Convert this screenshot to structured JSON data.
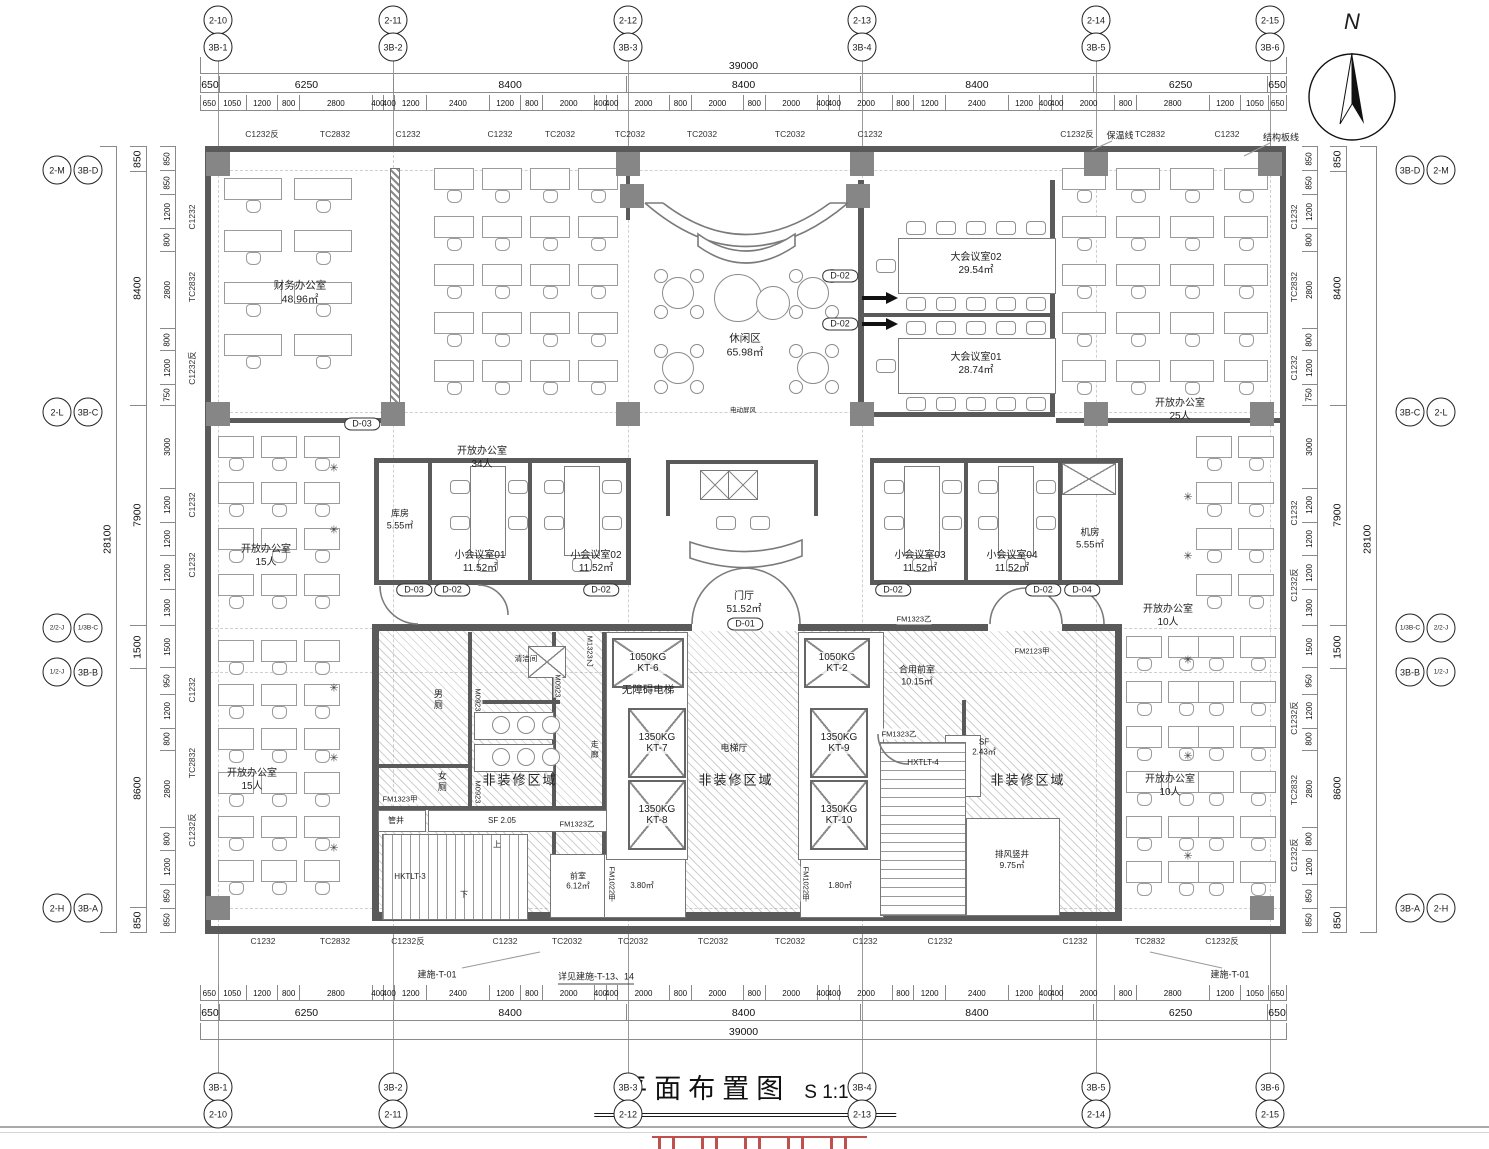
{
  "title": {
    "text": "平面布置图",
    "scale": "S 1:100"
  },
  "north": "N",
  "axes": {
    "top": [
      [
        "2-10",
        "3B-1"
      ],
      [
        "2-11",
        "3B-2"
      ],
      [
        "2-12",
        "3B-3"
      ],
      [
        "2-13",
        "3B-4"
      ],
      [
        "2-14",
        "3B-5"
      ],
      [
        "2-15",
        "3B-6"
      ]
    ],
    "bottom": [
      [
        "3B-1",
        "2-10"
      ],
      [
        "3B-2",
        "2-11"
      ],
      [
        "3B-3",
        "2-12"
      ],
      [
        "3B-4",
        "2-13"
      ],
      [
        "3B-5",
        "2-14"
      ],
      [
        "3B-6",
        "2-15"
      ]
    ],
    "left": [
      [
        "2-M",
        "3B-D"
      ],
      [
        "2-L",
        "3B-C"
      ],
      [
        "2/2-J",
        "1/3B-C"
      ],
      [
        "1/2-J",
        "3B-B"
      ],
      [
        "2-H",
        "3B-A"
      ]
    ],
    "right": [
      [
        "3B-D",
        "2-M"
      ],
      [
        "3B-C",
        "2-L"
      ],
      [
        "1/3B-C",
        "2/2-J"
      ],
      [
        "3B-B",
        "1/2-J"
      ],
      [
        "3B-A",
        "2-H"
      ]
    ]
  },
  "dimensions": {
    "top": {
      "overall": [
        39000
      ],
      "majors": [
        650,
        6250,
        8400,
        8400,
        8400,
        6250,
        650
      ],
      "minors": [
        650,
        1050,
        1200,
        800,
        2800,
        400,
        400,
        1200,
        2400,
        1200,
        800,
        2000,
        400,
        400,
        2000,
        800,
        2000,
        800,
        2000,
        400,
        400,
        2000,
        800,
        1200,
        2400,
        1200,
        400,
        400,
        2000,
        800,
        2800,
        1200,
        1050,
        650
      ]
    },
    "bottom": {
      "overall": [
        39000
      ],
      "majors": [
        650,
        6250,
        8400,
        8400,
        8400,
        6250,
        650
      ],
      "minors": [
        650,
        1050,
        1200,
        800,
        2800,
        400,
        400,
        1200,
        2400,
        1200,
        800,
        2000,
        400,
        400,
        2000,
        800,
        2000,
        800,
        2000,
        400,
        400,
        2000,
        800,
        1200,
        2400,
        1200,
        400,
        400,
        2000,
        800,
        2800,
        1200,
        1050,
        650
      ]
    },
    "left": {
      "overall": [
        28100
      ],
      "majors": [
        850,
        8400,
        7900,
        1500,
        8600,
        850
      ],
      "minors": [
        850,
        850,
        1200,
        800,
        2800,
        800,
        1200,
        750,
        3000,
        1200,
        1200,
        1200,
        1300,
        1500,
        950,
        1200,
        800,
        2800,
        800,
        1200,
        850,
        850
      ]
    },
    "right": {
      "overall": [
        28100
      ],
      "majors": [
        850,
        8400,
        7900,
        1500,
        8600,
        850
      ],
      "minors": [
        850,
        850,
        1200,
        800,
        2800,
        800,
        1200,
        750,
        3000,
        1200,
        1200,
        1200,
        1300,
        1500,
        950,
        1200,
        800,
        2800,
        800,
        1200,
        850,
        850
      ]
    }
  },
  "window_labels": {
    "top": [
      "C1232反",
      "TC2832",
      "C1232",
      "C1232",
      "TC2032",
      "TC2032",
      "TC2032",
      "TC2032",
      "C1232",
      "C1232反",
      "TC2832",
      "C1232"
    ],
    "bottom": [
      "C1232",
      "TC2832",
      "C1232反",
      "C1232",
      "TC2032",
      "TC2032",
      "TC2032",
      "TC2032",
      "C1232",
      "C1232",
      "C1232",
      "TC2832",
      "C1232反"
    ],
    "left": [
      "C1232",
      "TC2832",
      "C1232反",
      "C1232",
      "C1232",
      "C1232",
      "TC2832",
      "C1232反"
    ],
    "right": [
      "C1232",
      "TC2832",
      "C1232",
      "C1232",
      "C1232反",
      "C1232反",
      "TC2832",
      "C1232反"
    ]
  },
  "annotations": {
    "baowen": "保温线",
    "jiegou": "结构板线",
    "js_left": "建施-T-01",
    "js_mid": "详见建施-T-13、14",
    "js_right": "建施-T-01"
  },
  "rooms": {
    "finance": {
      "name": "财务办公室",
      "area": "48.96㎡"
    },
    "lounge": {
      "name": "休闲区",
      "area": "65.98㎡"
    },
    "meeting02": {
      "name": "大会议室02",
      "area": "29.54㎡"
    },
    "meeting01": {
      "name": "大会议室01",
      "area": "28.74㎡"
    },
    "open25": {
      "name": "开放办公室",
      "cap": "25人"
    },
    "open34": {
      "name": "开放办公室",
      "cap": "34人"
    },
    "open15a": {
      "name": "开放办公室",
      "cap": "15人"
    },
    "open15b": {
      "name": "开放办公室",
      "cap": "15人"
    },
    "open10a": {
      "name": "开放办公室",
      "cap": "10人"
    },
    "open10b": {
      "name": "开放办公室",
      "cap": "10人"
    },
    "storage": {
      "name": "库房",
      "area": "5.55㎡"
    },
    "small01": {
      "name": "小会议室01",
      "area": "11.52㎡"
    },
    "small02": {
      "name": "小会议室02",
      "area": "11.52㎡"
    },
    "small03": {
      "name": "小会议室03",
      "area": "11.52㎡"
    },
    "small04": {
      "name": "小会议室04",
      "area": "11.52㎡"
    },
    "server": {
      "name": "机房",
      "area": "5.55㎡"
    },
    "lobby": {
      "name": "门厅",
      "area": "51.52㎡"
    },
    "men": {
      "name": "男厕"
    },
    "women": {
      "name": "女厕"
    },
    "cleaning": {
      "name": "清洁间"
    },
    "corridor": {
      "name": "走廊"
    },
    "front": {
      "name": "前室",
      "area": "6.12㎡"
    },
    "shared_front": {
      "name": "合用前室",
      "area": "10.15㎡"
    },
    "exhaust": {
      "name": "排风竖井",
      "area": "9.75㎡"
    },
    "shaft_a": {
      "area": "3.80㎡"
    },
    "shaft_b": {
      "area": "1.80㎡"
    },
    "sf_a": {
      "name": "SF 2.05"
    },
    "sf_b": {
      "name": "SF",
      "area": "2.43㎡"
    },
    "pipe": {
      "name": "管井"
    },
    "nofit": {
      "name": "非装修区域"
    },
    "lift_hall": {
      "name": "电梯厅"
    },
    "barrier_free": {
      "name": "无障碍电梯"
    },
    "screen": {
      "name": "电动屏风"
    }
  },
  "elevators": [
    {
      "load": "1050KG",
      "id": "KT-6"
    },
    {
      "load": "1350KG",
      "id": "KT-7"
    },
    {
      "load": "1350KG",
      "id": "KT-8"
    },
    {
      "load": "1050KG",
      "id": "KT-2"
    },
    {
      "load": "1350KG",
      "id": "KT-9"
    },
    {
      "load": "1350KG",
      "id": "KT-10"
    }
  ],
  "stairs": {
    "left_id": "HKTLT-3",
    "right_id": "HXTLT-4",
    "up": "上",
    "down": "下"
  },
  "door_tags": {
    "d01": "D-01",
    "d02": "D-02",
    "d03": "D-03",
    "d04": "D-04"
  },
  "fire_tags": {
    "fm1323y": "FM1323乙",
    "fm1323j": "FM1323甲",
    "fm2123": "FM2123甲",
    "fm1022": "FM1022甲",
    "m0923": "M0923",
    "m1323": "M1323乙"
  }
}
